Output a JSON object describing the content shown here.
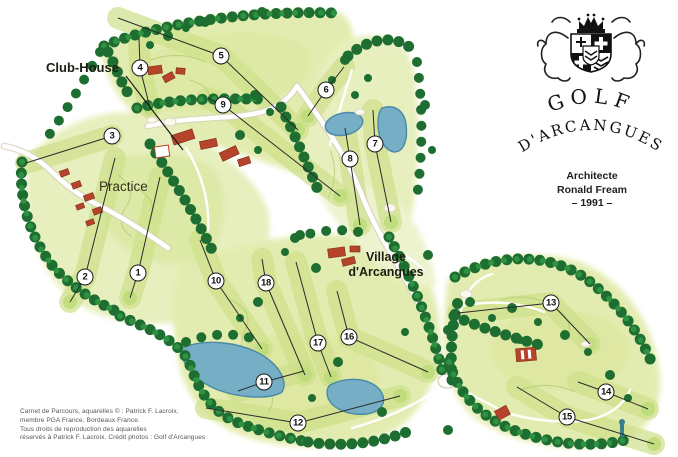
{
  "page": {
    "background": "#ffffff"
  },
  "logo": {
    "title_line1": "GOLF",
    "title_line2": "D'ARCANGUES",
    "crest_description": "coat of arms with crown, two lions and quartered shield"
  },
  "architect": {
    "line1": "Architecte",
    "line2": "Ronald Fream",
    "line3": "– 1991 –"
  },
  "credits": {
    "line1": "Carnet de Parcours, aquarelles © : Patrick F. Lacroix,",
    "line2": "membre PGA France, Bordeaux France.",
    "line3": "Tous droits de reproduction des aquarelles",
    "line4": "réservés à Patrick F. Lacroix. Crédit photos : Golf d'Arcangues"
  },
  "map": {
    "labels": {
      "club_house": "Club-House",
      "practice": "Practice",
      "village_line1": "Village",
      "village_line2": "d'Arcangues"
    },
    "club_house_pointer": [
      [
        126,
        76
      ],
      [
        183,
        150
      ]
    ],
    "holes": [
      {
        "number": "1",
        "x": 138,
        "y": 273,
        "line": [
          [
            160,
            177
          ],
          [
            138,
            273
          ],
          [
            130,
            298
          ]
        ]
      },
      {
        "number": "2",
        "x": 85,
        "y": 277,
        "line": [
          [
            115,
            158
          ],
          [
            85,
            277
          ],
          [
            70,
            302
          ]
        ]
      },
      {
        "number": "3",
        "x": 112,
        "y": 136,
        "line": [
          [
            26,
            163
          ],
          [
            112,
            136
          ]
        ]
      },
      {
        "number": "4",
        "x": 140,
        "y": 68,
        "line": [
          [
            139,
            38
          ],
          [
            140,
            68
          ],
          [
            150,
            108
          ]
        ]
      },
      {
        "number": "5",
        "x": 221,
        "y": 56,
        "line": [
          [
            118,
            18
          ],
          [
            221,
            56
          ],
          [
            298,
            130
          ]
        ]
      },
      {
        "number": "6",
        "x": 326,
        "y": 90,
        "line": [
          [
            344,
            67
          ],
          [
            326,
            90
          ],
          [
            308,
            116
          ]
        ]
      },
      {
        "number": "7",
        "x": 375,
        "y": 144,
        "line": [
          [
            373,
            110
          ],
          [
            375,
            144
          ],
          [
            391,
            222
          ]
        ]
      },
      {
        "number": "8",
        "x": 350,
        "y": 159,
        "line": [
          [
            345,
            128
          ],
          [
            350,
            159
          ],
          [
            360,
            225
          ]
        ]
      },
      {
        "number": "9",
        "x": 223,
        "y": 105,
        "line": [
          [
            208,
            98
          ],
          [
            223,
            105
          ],
          [
            340,
            196
          ]
        ]
      },
      {
        "number": "10",
        "x": 216,
        "y": 281,
        "line": [
          [
            200,
            240
          ],
          [
            216,
            281
          ],
          [
            262,
            349
          ]
        ]
      },
      {
        "number": "11",
        "x": 264,
        "y": 382,
        "line": [
          [
            238,
            391
          ],
          [
            264,
            382
          ],
          [
            304,
            371
          ]
        ]
      },
      {
        "number": "12",
        "x": 298,
        "y": 423,
        "line": [
          [
            206,
            408
          ],
          [
            298,
            423
          ],
          [
            400,
            396
          ]
        ]
      },
      {
        "number": "13",
        "x": 551,
        "y": 303,
        "line": [
          [
            458,
            313
          ],
          [
            551,
            303
          ],
          [
            590,
            344
          ]
        ]
      },
      {
        "number": "14",
        "x": 606,
        "y": 392,
        "line": [
          [
            578,
            382
          ],
          [
            606,
            392
          ],
          [
            648,
            409
          ]
        ]
      },
      {
        "number": "15",
        "x": 567,
        "y": 417,
        "line": [
          [
            517,
            387
          ],
          [
            567,
            417
          ],
          [
            654,
            444
          ]
        ]
      },
      {
        "number": "16",
        "x": 349,
        "y": 337,
        "line": [
          [
            337,
            291
          ],
          [
            349,
            337
          ],
          [
            428,
            372
          ]
        ]
      },
      {
        "number": "17",
        "x": 318,
        "y": 343,
        "line": [
          [
            296,
            262
          ],
          [
            318,
            343
          ],
          [
            331,
            377
          ]
        ]
      },
      {
        "number": "18",
        "x": 266,
        "y": 283,
        "line": [
          [
            262,
            259
          ],
          [
            266,
            283
          ],
          [
            305,
            375
          ]
        ]
      }
    ],
    "colors": {
      "water": "#76aec6",
      "tree_dark": "#1d6e30",
      "tree_light": "#2f9242",
      "fairway": "#cde089",
      "rough": "#e3ecb0",
      "building_red": "#b5442a",
      "hole_line": "#2b2b2b"
    }
  }
}
